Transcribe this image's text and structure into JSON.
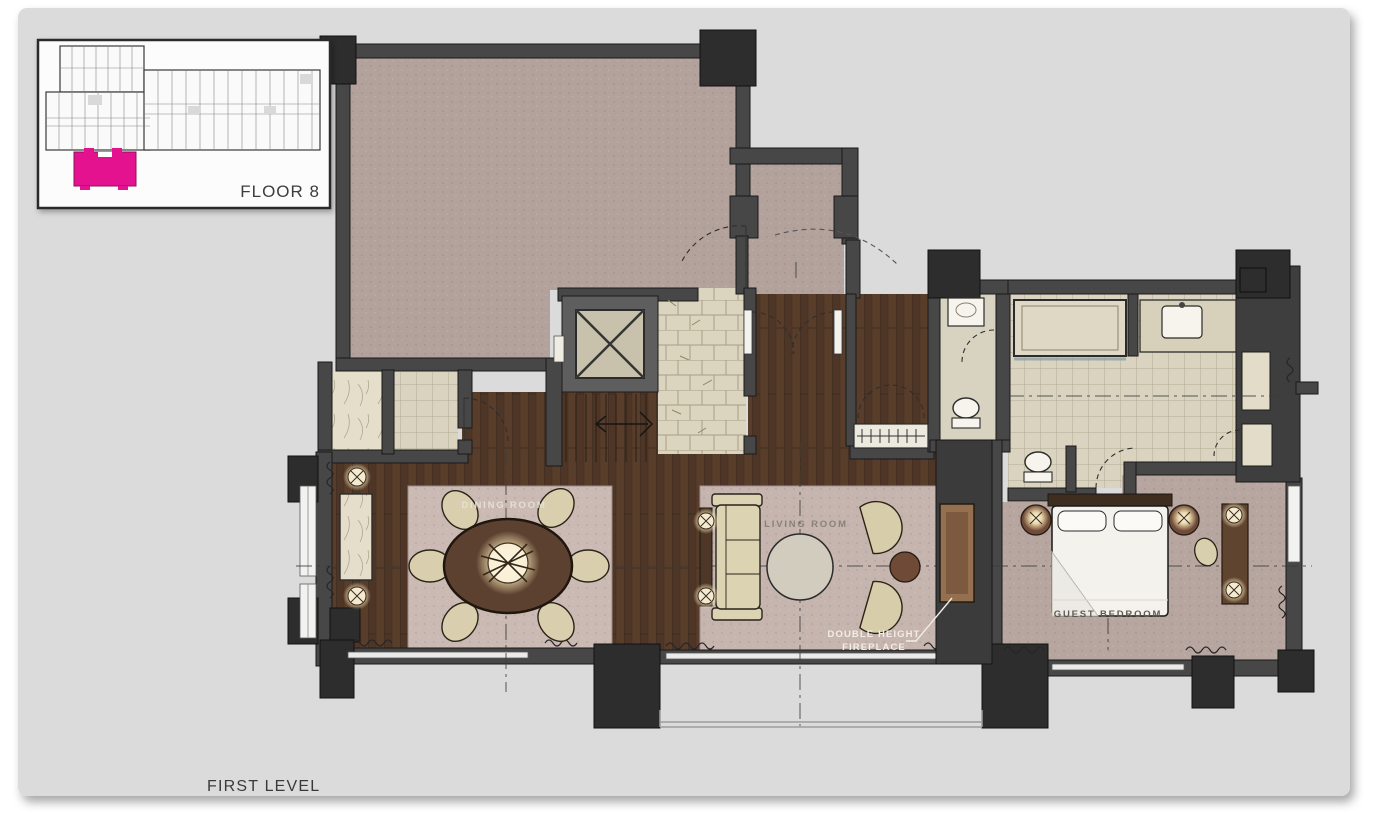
{
  "slide": {
    "background_color": "#dbdbdb",
    "page_background": "#ffffff"
  },
  "keyplan": {
    "floor_label": "FLOOR 8",
    "highlight_color": "#e5128f"
  },
  "plan": {
    "level_label": "FIRST LEVEL",
    "rooms": {
      "dining": "DINING ROOM",
      "living": "LIVING ROOM",
      "guest_bedroom": "GUEST BEDROOM"
    },
    "annotation": {
      "fireplace_line1": "DOUBLE HEIGHT",
      "fireplace_line2": "FIREPLACE"
    }
  },
  "palette": {
    "wall": "#474747",
    "column": "#2d2d2d",
    "wood_floor": "#583d2b",
    "carpet_mauve": "#b3a19c",
    "bedroom_carpet": "#b7a5a0",
    "dining_rug": "#cbbab4",
    "living_rug": "#c6b5af",
    "tile_cream": "#dbd4be",
    "marble": "#e4decb",
    "furniture_cream": "#d9cfae",
    "table_wood": "#5d4130",
    "fireplace_brown": "#957050",
    "lamp_glow": "#ffeebc"
  }
}
